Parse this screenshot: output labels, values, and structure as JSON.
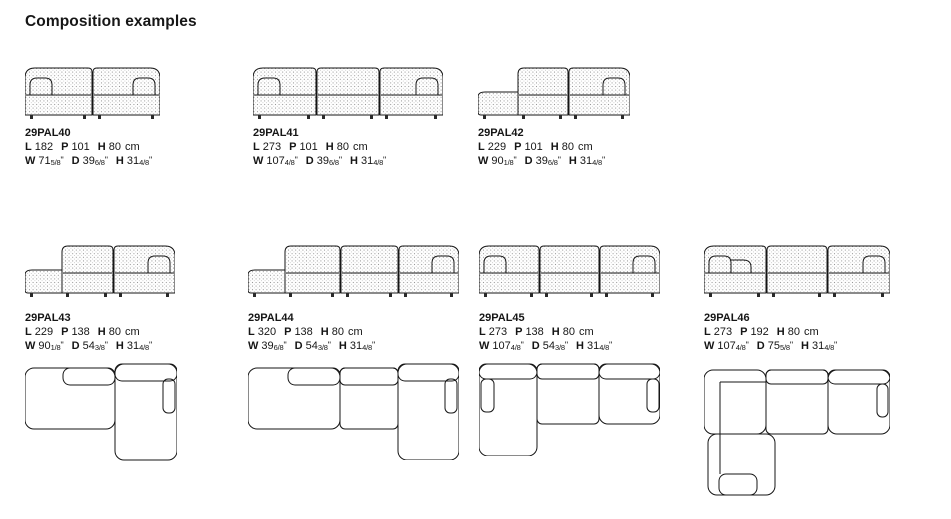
{
  "title": "Composition examples",
  "metric_legend": {
    "length": "L",
    "depth": "P",
    "height": "H"
  },
  "compositions": [
    {
      "code": "29PAL40",
      "metric": [
        {
          "label": "L",
          "value": "182"
        },
        {
          "label": "P",
          "value": "101"
        },
        {
          "label": "H",
          "value": "80"
        }
      ],
      "metric_unit": "cm",
      "imperial": [
        {
          "label": "W",
          "whole": "71",
          "frac": "5/8",
          "mark": "\""
        },
        {
          "label": "D",
          "whole": "39",
          "frac": "6/8",
          "mark": "\""
        },
        {
          "label": "H",
          "whole": "31",
          "frac": "4/8",
          "mark": "\""
        }
      ]
    },
    {
      "code": "29PAL41",
      "metric": [
        {
          "label": "L",
          "value": "273"
        },
        {
          "label": "P",
          "value": "101"
        },
        {
          "label": "H",
          "value": "80"
        }
      ],
      "metric_unit": "cm",
      "imperial": [
        {
          "label": "W",
          "whole": "107",
          "frac": "4/8",
          "mark": "\""
        },
        {
          "label": "D",
          "whole": "39",
          "frac": "6/8",
          "mark": "\""
        },
        {
          "label": "H",
          "whole": "31",
          "frac": "4/8",
          "mark": "\""
        }
      ]
    },
    {
      "code": "29PAL42",
      "metric": [
        {
          "label": "L",
          "value": "229"
        },
        {
          "label": "P",
          "value": "101"
        },
        {
          "label": "H",
          "value": "80"
        }
      ],
      "metric_unit": "cm",
      "imperial": [
        {
          "label": "W",
          "whole": "90",
          "frac": "1/8",
          "mark": "\""
        },
        {
          "label": "D",
          "whole": "39",
          "frac": "6/8",
          "mark": "\""
        },
        {
          "label": "H",
          "whole": "31",
          "frac": "4/8",
          "mark": "\""
        }
      ]
    },
    {
      "code": "29PAL43",
      "metric": [
        {
          "label": "L",
          "value": "229"
        },
        {
          "label": "P",
          "value": "138"
        },
        {
          "label": "H",
          "value": "80"
        }
      ],
      "metric_unit": "cm",
      "imperial": [
        {
          "label": "W",
          "whole": "90",
          "frac": "1/8",
          "mark": "\""
        },
        {
          "label": "D",
          "whole": "54",
          "frac": "3/8",
          "mark": "\""
        },
        {
          "label": "H",
          "whole": "31",
          "frac": "4/8",
          "mark": "\""
        }
      ]
    },
    {
      "code": "29PAL44",
      "metric": [
        {
          "label": "L",
          "value": "320"
        },
        {
          "label": "P",
          "value": "138"
        },
        {
          "label": "H",
          "value": "80"
        }
      ],
      "metric_unit": "cm",
      "imperial": [
        {
          "label": "W",
          "whole": "39",
          "frac": "6/8",
          "mark": "\""
        },
        {
          "label": "D",
          "whole": "54",
          "frac": "3/8",
          "mark": "\""
        },
        {
          "label": "H",
          "whole": "31",
          "frac": "4/8",
          "mark": "\""
        }
      ]
    },
    {
      "code": "29PAL45",
      "metric": [
        {
          "label": "L",
          "value": "273"
        },
        {
          "label": "P",
          "value": "138"
        },
        {
          "label": "H",
          "value": "80"
        }
      ],
      "metric_unit": "cm",
      "imperial": [
        {
          "label": "W",
          "whole": "107",
          "frac": "4/8",
          "mark": "\""
        },
        {
          "label": "D",
          "whole": "54",
          "frac": "3/8",
          "mark": "\""
        },
        {
          "label": "H",
          "whole": "31",
          "frac": "4/8",
          "mark": "\""
        }
      ]
    },
    {
      "code": "29PAL46",
      "metric": [
        {
          "label": "L",
          "value": "273"
        },
        {
          "label": "P",
          "value": "192"
        },
        {
          "label": "H",
          "value": "80"
        }
      ],
      "metric_unit": "cm",
      "imperial": [
        {
          "label": "W",
          "whole": "107",
          "frac": "4/8",
          "mark": "\""
        },
        {
          "label": "D",
          "whole": "75",
          "frac": "5/8",
          "mark": "\""
        },
        {
          "label": "H",
          "whole": "31",
          "frac": "4/8",
          "mark": "\""
        }
      ]
    }
  ]
}
